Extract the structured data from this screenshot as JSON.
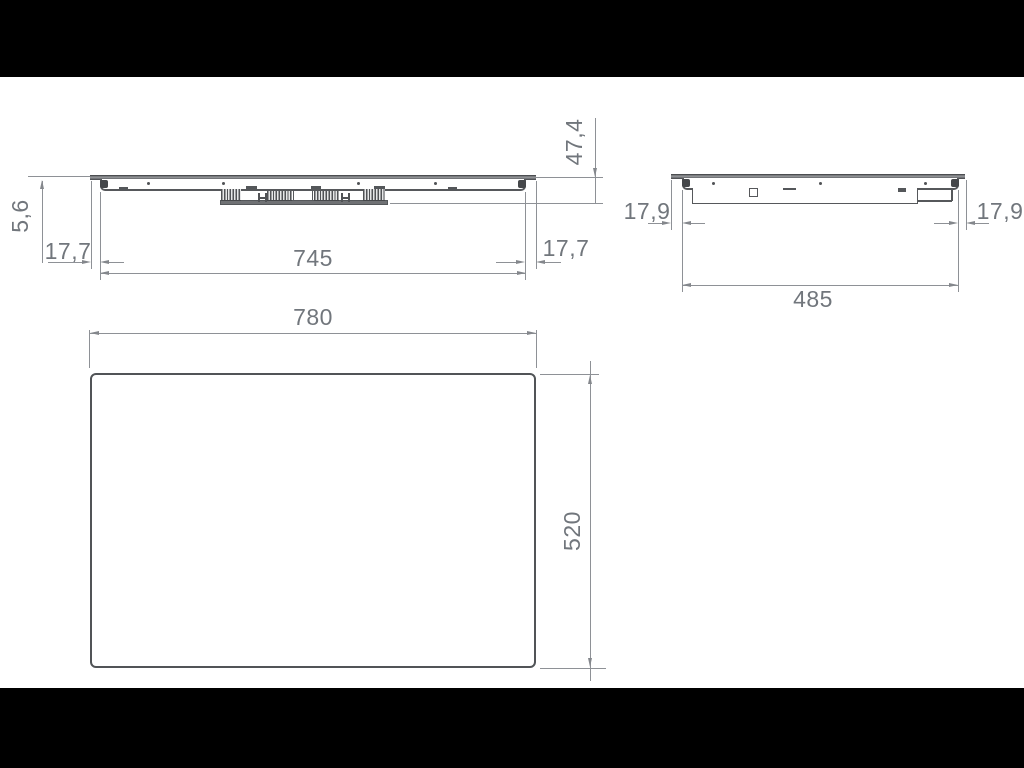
{
  "page": {
    "background": "#ffffff",
    "letterbox_color": "#000000"
  },
  "drawing": {
    "type": "technical-dimension-drawing",
    "subject": "built-in hob outline drawing",
    "units_style": "comma-decimal millimetres",
    "views": {
      "front": {
        "name": "front-elevation",
        "dimensions": {
          "glass_thickness": "5,6",
          "left_inset": "17,7",
          "body_width": "745",
          "right_inset": "17,7",
          "overall_height": "47,4"
        }
      },
      "side": {
        "name": "side-elevation",
        "dimensions": {
          "left_inset": "17,9",
          "body_depth": "485",
          "right_inset": "17,9"
        }
      },
      "plan": {
        "name": "plan-view",
        "dimensions": {
          "overall_width": "780",
          "overall_depth": "520"
        }
      }
    },
    "colors": {
      "object_line": "#56585b",
      "dimension_line": "#8e9196",
      "arrow": "#84878c",
      "text": "#71767c"
    }
  }
}
